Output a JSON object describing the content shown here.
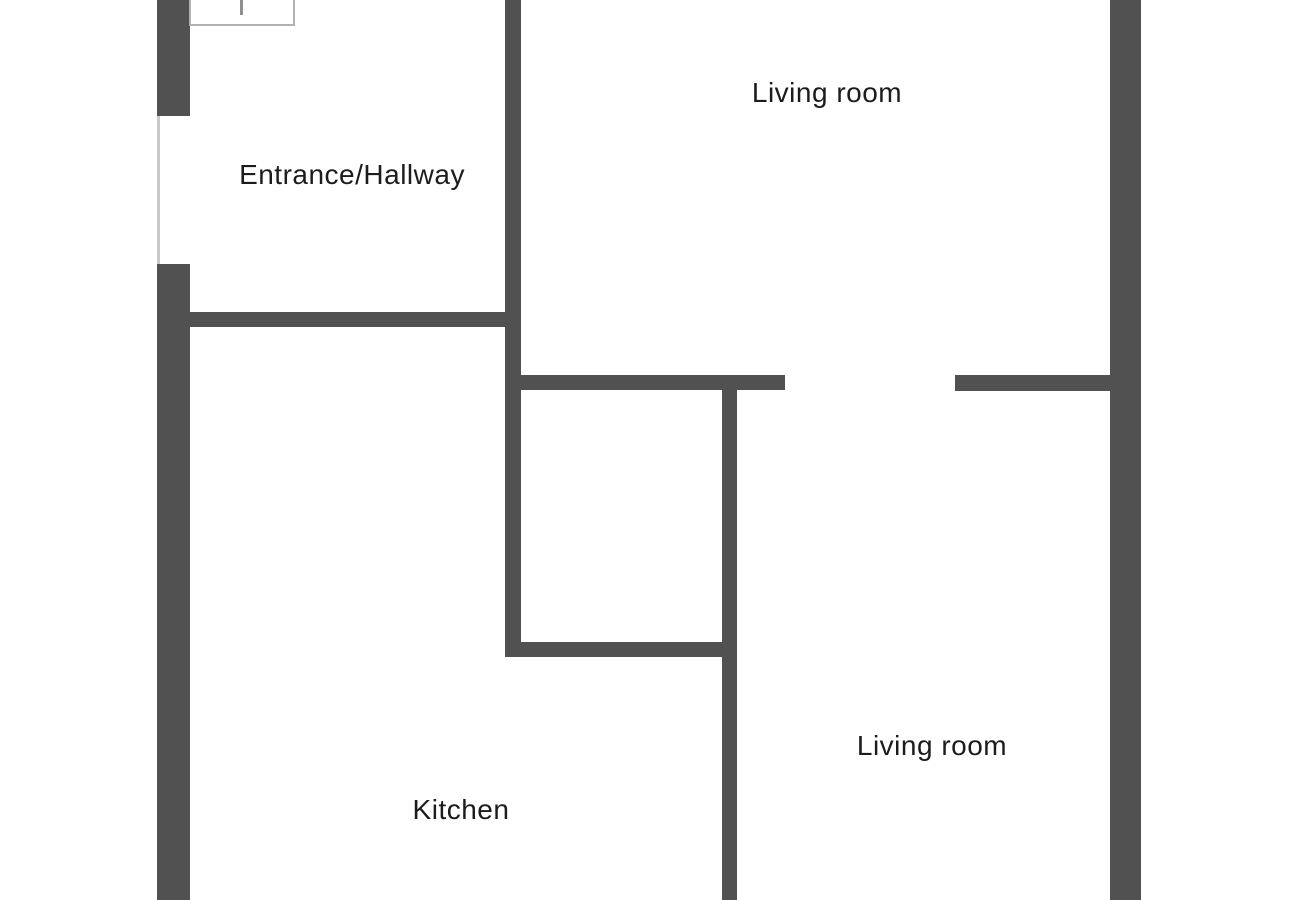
{
  "diagram": {
    "type": "floor-plan",
    "rooms": [
      {
        "id": "living-room-upper",
        "label": "Living room"
      },
      {
        "id": "entrance-hallway",
        "label": "Entrance/Hallway"
      },
      {
        "id": "kitchen",
        "label": "Kitchen"
      },
      {
        "id": "living-room-lower",
        "label": "Living room"
      }
    ],
    "colors": {
      "wall": "#515151",
      "background": "#ffffff",
      "label_text": "#1c1c1c",
      "window_outline": "#b2b2b2",
      "opening_line": "#c9c9c9",
      "window_tick": "#8f8f8f"
    }
  }
}
